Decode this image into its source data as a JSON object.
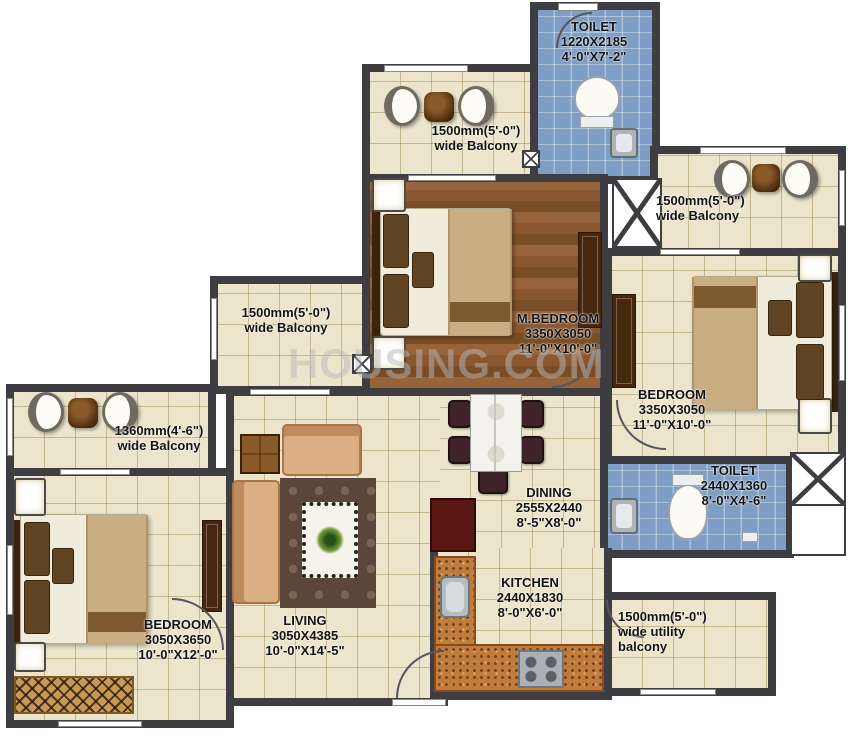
{
  "watermark": "HOUSING.COM",
  "colors": {
    "wall": "#3e3d42",
    "floor_tile": "#ece5cc",
    "toilet_tile": "#7f9ec5",
    "wood_floor": "#8a5731",
    "granite_counter": "#c07c3c",
    "sofa_tan": "#dcae84",
    "label_text": "#121212"
  },
  "rooms": {
    "toilet_top": {
      "name": "TOILET",
      "dim_mm": "1220X2185",
      "dim_ft": "4'-0\"X7'-2\""
    },
    "balcony_top": {
      "line1": "1500mm(5'-0\")",
      "line2": "wide Balcony"
    },
    "mbedroom": {
      "name": "M.BEDROOM",
      "dim_mm": "3350X3050",
      "dim_ft": "11'-0\"X10'-0\""
    },
    "balcony_right": {
      "line1": "1500mm(5'-0\")",
      "line2": "wide Balcony"
    },
    "bedroom_right": {
      "name": "BEDROOM",
      "dim_mm": "3350X3050",
      "dim_ft": "11'-0\"X10'-0\""
    },
    "toilet_right": {
      "name": "TOILET",
      "dim_mm": "2440X1360",
      "dim_ft": "8'-0\"X4'-6\""
    },
    "balcony_midleft": {
      "line1": "1500mm(5'-0\")",
      "line2": "wide Balcony"
    },
    "balcony_left": {
      "line1": "1360mm(4'-6\")",
      "line2": "wide Balcony"
    },
    "bedroom_left": {
      "name": "BEDROOM",
      "dim_mm": "3050X3650",
      "dim_ft": "10'-0\"X12'-0\""
    },
    "living": {
      "name": "LIVING",
      "dim_mm": "3050X4385",
      "dim_ft": "10'-0\"X14'-5\""
    },
    "dining": {
      "name": "DINING",
      "dim_mm": "2555X2440",
      "dim_ft": "8'-5\"X8'-0\""
    },
    "kitchen": {
      "name": "KITCHEN",
      "dim_mm": "2440X1830",
      "dim_ft": "8'-0\"X6'-0\""
    },
    "utility": {
      "line1": "1500mm(5'-0\")",
      "line2": "wide utility",
      "line3": "balcony"
    }
  }
}
